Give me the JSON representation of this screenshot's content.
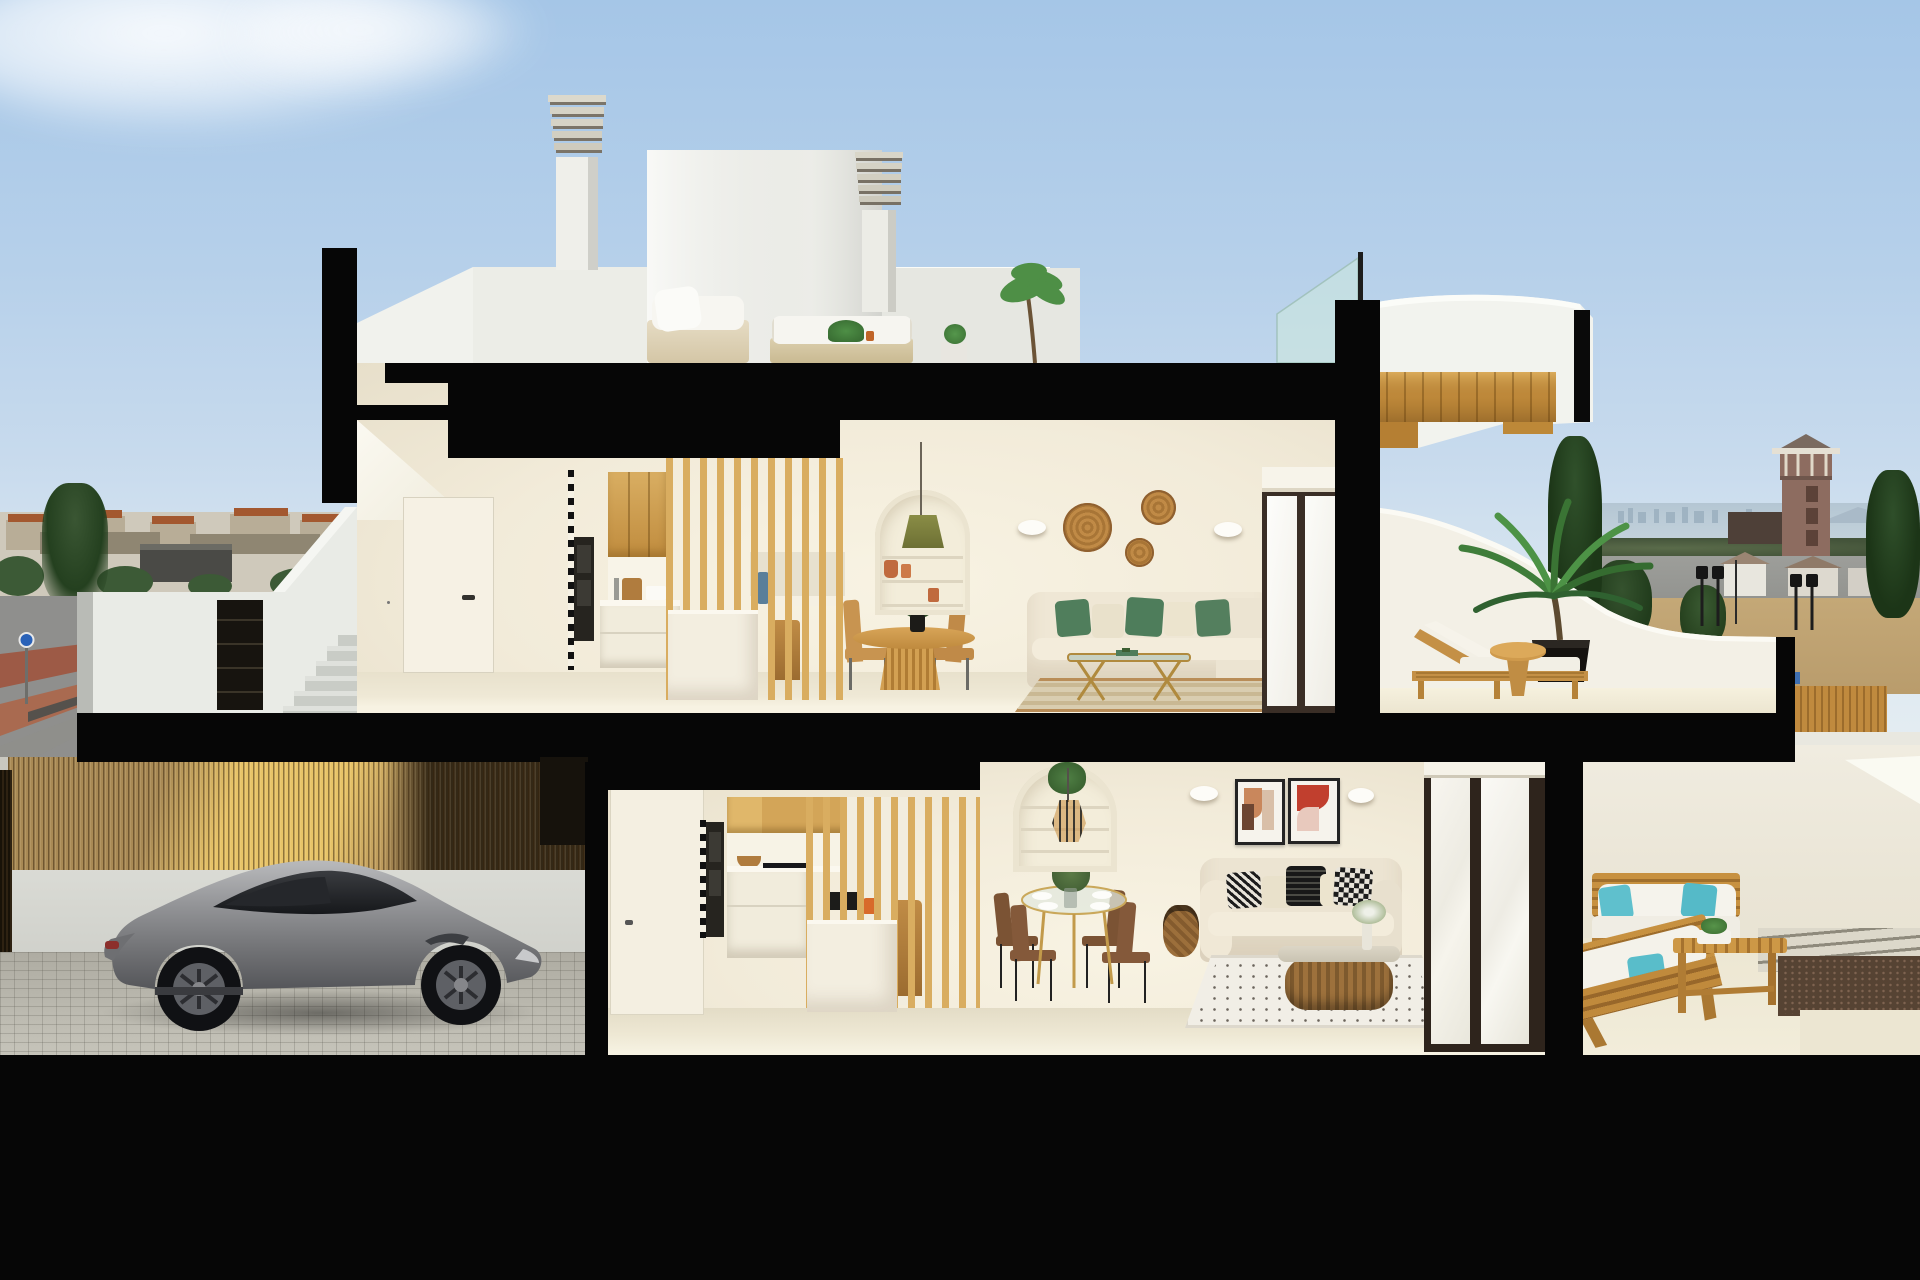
{
  "scene": {
    "title": "Cross-section 3D render of a modern two-storey Mediterranean villa with roof terrace, garage and patios",
    "type": "architectural cutaway rendering",
    "time_of_day": "daytime, clear sky"
  },
  "palette": {
    "sky_top": "#a5c6e7",
    "sky_horizon": "#e7eef3",
    "section_cut": "#060606",
    "interior_wall": "#f2ebd9",
    "interior_floor": "#e8e1cc",
    "exterior_white": "#f2f3ee",
    "oak_wood": "#d9ad60",
    "teak_wood": "#c79140",
    "fence_wood": "#a98a55",
    "green_pillow": "#507e5c",
    "teal_pillow": "#5fc0cd",
    "car_silver": "#909194",
    "terracotta": "#c06a3e",
    "sea": "#b4c6d3",
    "field": "#c4a877"
  },
  "background": {
    "left": {
      "items": [
        "distant town skyline with terracotta roofs",
        "dark conifer tree",
        "industrial shed",
        "grey road with red-brown sidewalk bands",
        "blue circular road sign"
      ]
    },
    "right": {
      "items": [
        "sea horizon with distant high-rise skyline",
        "watch tower with pyramid roof",
        "dry field with shrubs",
        "street lanterns",
        "small white houses",
        "tall conifers",
        "wooden street fence"
      ]
    }
  },
  "house": {
    "roof_level": {
      "items": [
        "louvred chimney stack left",
        "louvred chimney stack right",
        "white penthouse volumes",
        "roof terrace parapet",
        "white outdoor sofas with cushions",
        "potted plants and small tree",
        "glass balustrade with post",
        "curved white wing roof with stepped timber soffit"
      ]
    },
    "upper_floor": {
      "hallway": [
        "white interior door with black handle",
        "staircase soffit"
      ],
      "kitchen": [
        "oak upper cabinets",
        "built-in black ovens",
        "white base units",
        "white island",
        "oak slat partition",
        "bar stool",
        "blue bottle on shelf"
      ],
      "dining": [
        "round oak pedestal table",
        "woven oak chairs",
        "dark green centerpiece plant",
        "arched shelf niche with terracotta pots",
        "green pendant lamp"
      ],
      "living": [
        "cream L-shaped sofa",
        "green and cream cushions",
        "gold glass coffee table",
        "striped beige rug",
        "three rattan wall baskets",
        "two white wall sconces",
        "sliding glass door with roller-blind housing"
      ]
    },
    "upper_terrace": {
      "items": [
        "curved white parapet",
        "teak sun lounger with white cushion",
        "round teak side table",
        "large palm in black pot"
      ]
    },
    "ground_floor": {
      "kitchen": [
        "oak upper cabinets",
        "built-in black ovens",
        "induction hob",
        "white base units",
        "oak slat partition",
        "white island",
        "microwave niche",
        "orange kettle",
        "bar stool"
      ],
      "dining": [
        "round glass table with gold legs",
        "four walnut chairs",
        "white flower centerpiece",
        "arched shelf niche",
        "caged pendant lamp",
        "rattan floor urn"
      ],
      "living": [
        "cream sofa",
        "black and white patterned cushions",
        "rattan-base oval coffee table",
        "white dotted rug",
        "two abstract wall artworks",
        "two wall sconces",
        "sliding glass door with blinds"
      ]
    },
    "garage": {
      "items": [
        "vertical timber slat fence",
        "sunlit wall behind fence",
        "silver sports coupe",
        "cobblestone paver floor"
      ]
    },
    "right_patio": {
      "items": [
        "white boundary walls",
        "teak garden sofa with white cushions and teal pillows",
        "second angled teak sofa",
        "slatted teak coffee bench with plant",
        "stone walkway strips",
        "brown gravel bed"
      ]
    }
  },
  "site": {
    "left_items": [
      "white boundary wall with concrete stairs",
      "dark louvred gate",
      "street with red sidewalk"
    ],
    "bottom": "solid black ground band"
  }
}
